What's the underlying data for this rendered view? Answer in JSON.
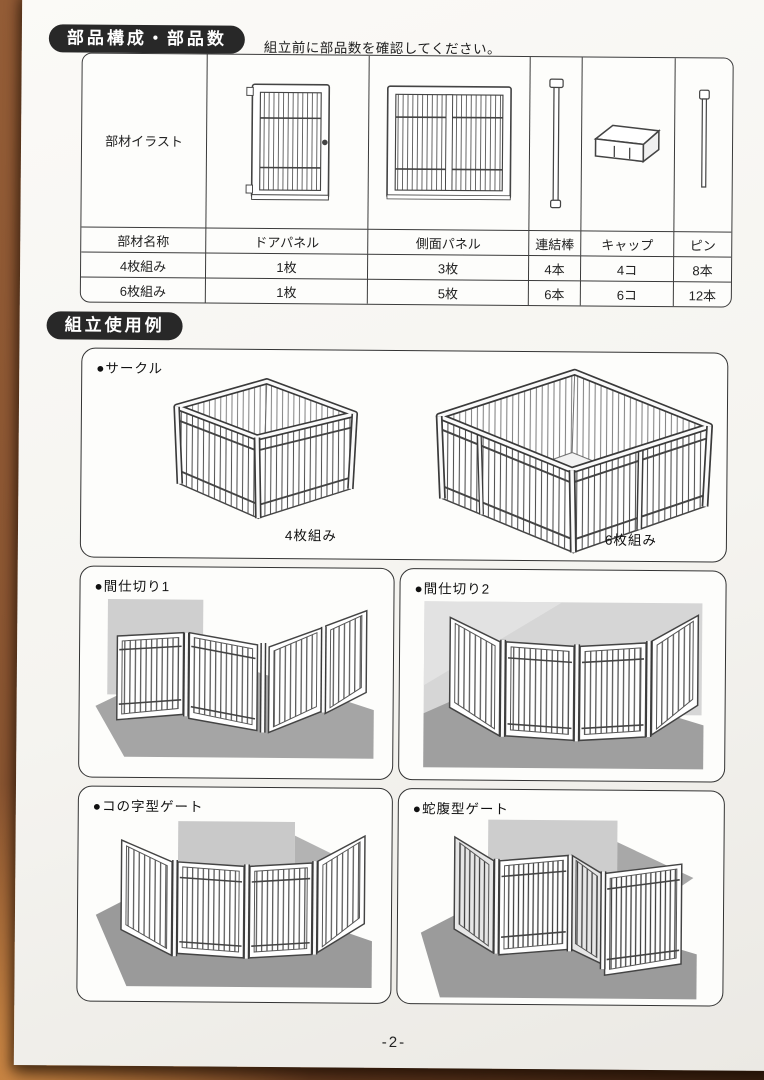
{
  "page": {
    "number": "-2-"
  },
  "parts_section": {
    "title": "部品構成・部品数",
    "note": "組立前に部品数を確認してください。",
    "table": {
      "illust_label": "部材イラスト",
      "name_header": "部材名称",
      "columns": [
        "ドアパネル",
        "側面パネル",
        "連結棒",
        "キャップ",
        "ピン"
      ],
      "icon_names": [
        "door-panel-icon",
        "side-panel-icon",
        "connect-rod-icon",
        "cap-icon",
        "pin-icon"
      ],
      "rows": [
        {
          "label": "4枚組み",
          "values": [
            "1枚",
            "3枚",
            "4本",
            "4コ",
            "8本"
          ]
        },
        {
          "label": "6枚組み",
          "values": [
            "1枚",
            "5枚",
            "6本",
            "6コ",
            "12本"
          ]
        }
      ]
    }
  },
  "usage_section": {
    "title": "組立使用例",
    "circle": {
      "label": "●サークル",
      "caption_left": "4枚組み",
      "caption_right": "6枚組み"
    },
    "examples": [
      {
        "label": "●間仕切り1"
      },
      {
        "label": "●間仕切り2"
      },
      {
        "label": "●コの字型ゲート"
      },
      {
        "label": "●蛇腹型ゲート"
      }
    ]
  },
  "colors": {
    "header_pill": "#282828",
    "paper": "#f7f6f2",
    "wood": "#8a5431",
    "shade_light": "#cfcfcf",
    "shade_dark": "#9f9f9f"
  }
}
